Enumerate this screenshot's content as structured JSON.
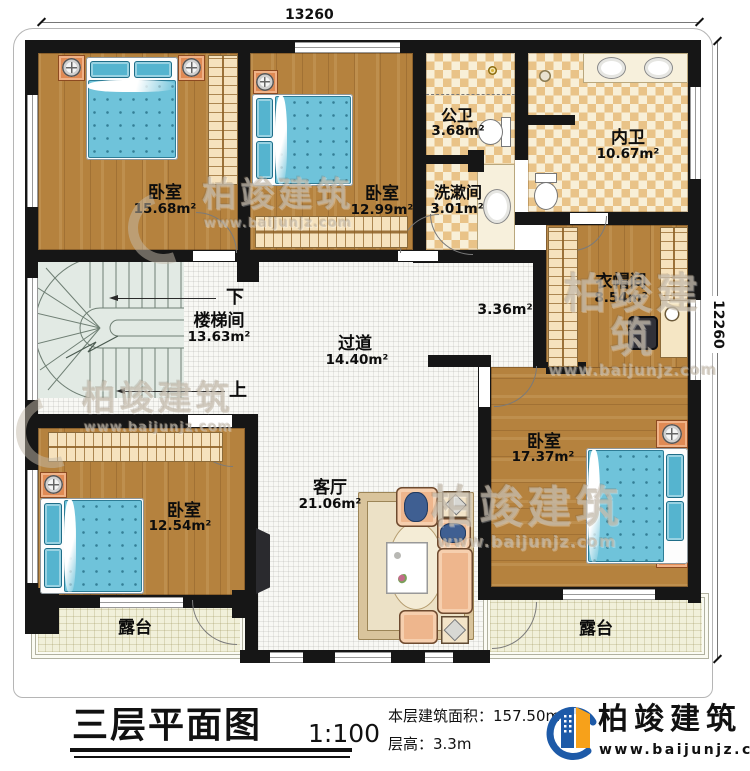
{
  "dimensions": {
    "width_mm": "13260",
    "height_mm": "12260"
  },
  "rooms": {
    "bedroom_tl": {
      "name": "卧室",
      "area": "15.68m²"
    },
    "bedroom_tm": {
      "name": "卧室",
      "area": "12.99m²"
    },
    "public_bath": {
      "name": "公卫",
      "area": "3.68m²"
    },
    "washroom": {
      "name": "洗漱间",
      "area": "3.01m²"
    },
    "master_bath": {
      "name": "内卫",
      "area": "10.67m²"
    },
    "cloakroom": {
      "name": "衣帽间",
      "area": "8.54m²"
    },
    "stairwell": {
      "name": "楼梯间",
      "area": "13.63m²"
    },
    "hallway": {
      "name": "过道",
      "area": "14.40m²"
    },
    "inner_hall": {
      "area": "3.36m²"
    },
    "living": {
      "name": "客厅",
      "area": "21.06m²"
    },
    "bedroom_bl": {
      "name": "卧室",
      "area": "12.54m²"
    },
    "bedroom_br": {
      "name": "卧室",
      "area": "17.37m²"
    },
    "terrace_left": {
      "name": "露台"
    },
    "terrace_right": {
      "name": "露台"
    }
  },
  "stairs": {
    "down_label": "下",
    "up_label": "上"
  },
  "title_block": {
    "title": "三层平面图",
    "scale": "1:100",
    "floor_area": "本层建筑面积：157.50m²",
    "floor_height": "层高：3.3m"
  },
  "brand": {
    "name": "柏竣建筑",
    "website": "www.baijunjz.com"
  },
  "watermarks": {
    "name": "柏竣建筑",
    "website": "www.baijunjz.com"
  },
  "colors": {
    "wall": "#161616",
    "wood": "#b5823e",
    "checker_tan": "#e9c388",
    "floor_tile": "#f8f8f4",
    "bed_blue": "#6fc3da",
    "terrace": "#f1f0da",
    "brand_blue": "#1d5aa8",
    "brand_orange": "#f7a11a"
  }
}
